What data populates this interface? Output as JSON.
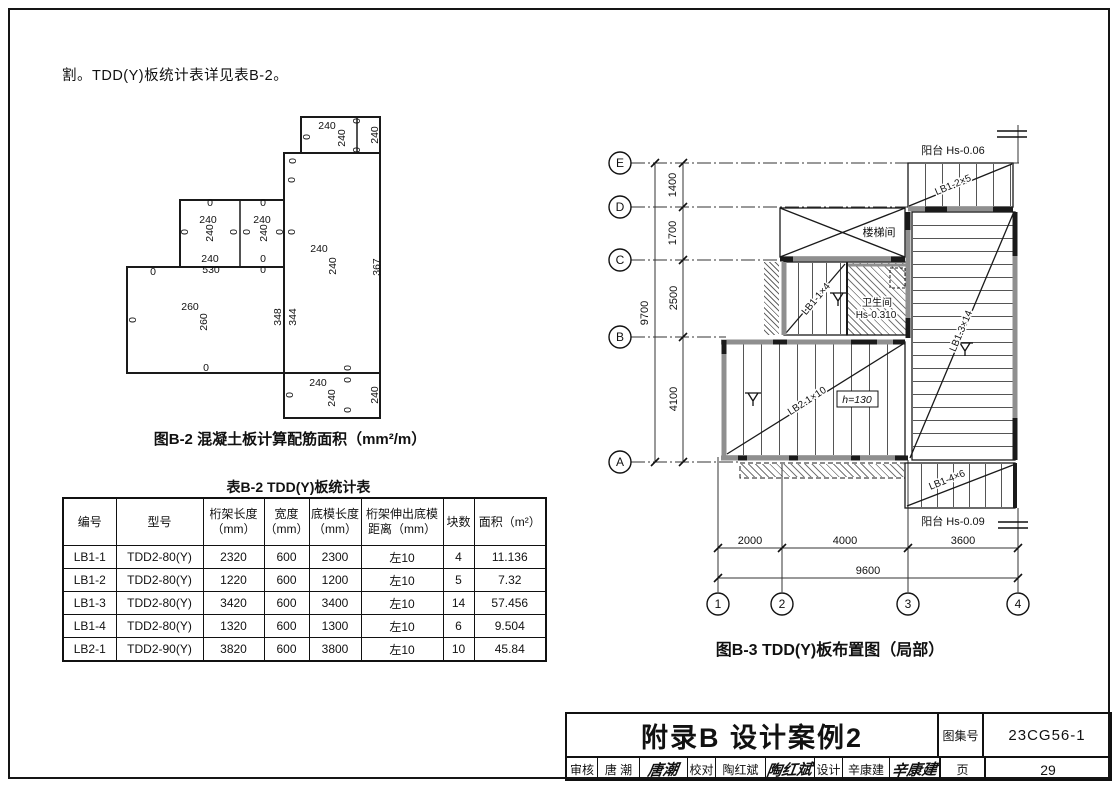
{
  "intro": {
    "text": "割。TDD(Y)板统计表详见表B-2。"
  },
  "fig_b2": {
    "caption": "图B-2 混凝土板计算配筋面积（mm²/m）",
    "labels": [
      "0",
      "240",
      "240",
      "0",
      "0",
      "240",
      "0",
      "0",
      "240",
      "240",
      "367",
      "0",
      "240",
      "240",
      "0",
      "0",
      "0",
      "0",
      "240",
      "240",
      "0",
      "0",
      "240",
      "530",
      "0",
      "0",
      "0",
      "260",
      "260",
      "0",
      "0",
      "348",
      "344",
      "0",
      "240",
      "0",
      "240",
      "0",
      "240",
      "0"
    ]
  },
  "table_b2": {
    "title": "表B-2 TDD(Y)板统计表",
    "headers": [
      "编号",
      "型号",
      "桁架长度\n（mm）",
      "宽度\n（mm）",
      "底模长度\n（mm）",
      "桁架伸出底模\n距离（mm）",
      "块数",
      "面积（m²）"
    ],
    "rows": [
      [
        "LB1-1",
        "TDD2-80(Y)",
        "2320",
        "600",
        "2300",
        "左10",
        "4",
        "11.136"
      ],
      [
        "LB1-2",
        "TDD2-80(Y)",
        "1220",
        "600",
        "1200",
        "左10",
        "5",
        "7.32"
      ],
      [
        "LB1-3",
        "TDD2-80(Y)",
        "3420",
        "600",
        "3400",
        "左10",
        "14",
        "57.456"
      ],
      [
        "LB1-4",
        "TDD2-80(Y)",
        "1320",
        "600",
        "1300",
        "左10",
        "6",
        "9.504"
      ],
      [
        "LB2-1",
        "TDD2-90(Y)",
        "3820",
        "600",
        "3800",
        "左10",
        "10",
        "45.84"
      ]
    ]
  },
  "fig_b3": {
    "caption": "图B-3 TDD(Y)板布置图（局部）",
    "grid_rows": [
      "E",
      "D",
      "C",
      "B",
      "A"
    ],
    "grid_cols": [
      "1",
      "2",
      "3",
      "4"
    ],
    "dims_left": [
      "1400",
      "1700",
      "2500",
      "4100"
    ],
    "dim_left_total": "9700",
    "dims_bottom": [
      "2000",
      "4000",
      "3600"
    ],
    "dim_bottom_total": "9600",
    "labels": {
      "balcony_top": "阳台 Hs-0.06",
      "balcony_bottom": "阳台 Hs-0.09",
      "stair": "楼梯间",
      "bath": "卫生间",
      "bath_level": "Hs-0.310",
      "panel_top": "LB1-2×5",
      "panel_left": "LB1-1×4",
      "panel_right": "LB1-3×14",
      "panel_mid": "LB2-1×10",
      "panel_bottom": "LB1-4×6",
      "height_note": "h=130"
    }
  },
  "title_block": {
    "title": "附录B 设计案例2",
    "atlas_label": "图集号",
    "atlas_no": "23CG56-1",
    "page_label": "页",
    "page_no": "29",
    "cells": [
      {
        "label": "审核",
        "name": "唐 潮",
        "sig": "唐潮"
      },
      {
        "label": "校对",
        "name": "陶红斌",
        "sig": "陶红斌"
      },
      {
        "label": "设计",
        "name": "辛康建",
        "sig": "辛康建"
      }
    ]
  },
  "colors": {
    "line": "#111111",
    "wall_gray": "#8f8f8f",
    "paper": "#ffffff"
  }
}
